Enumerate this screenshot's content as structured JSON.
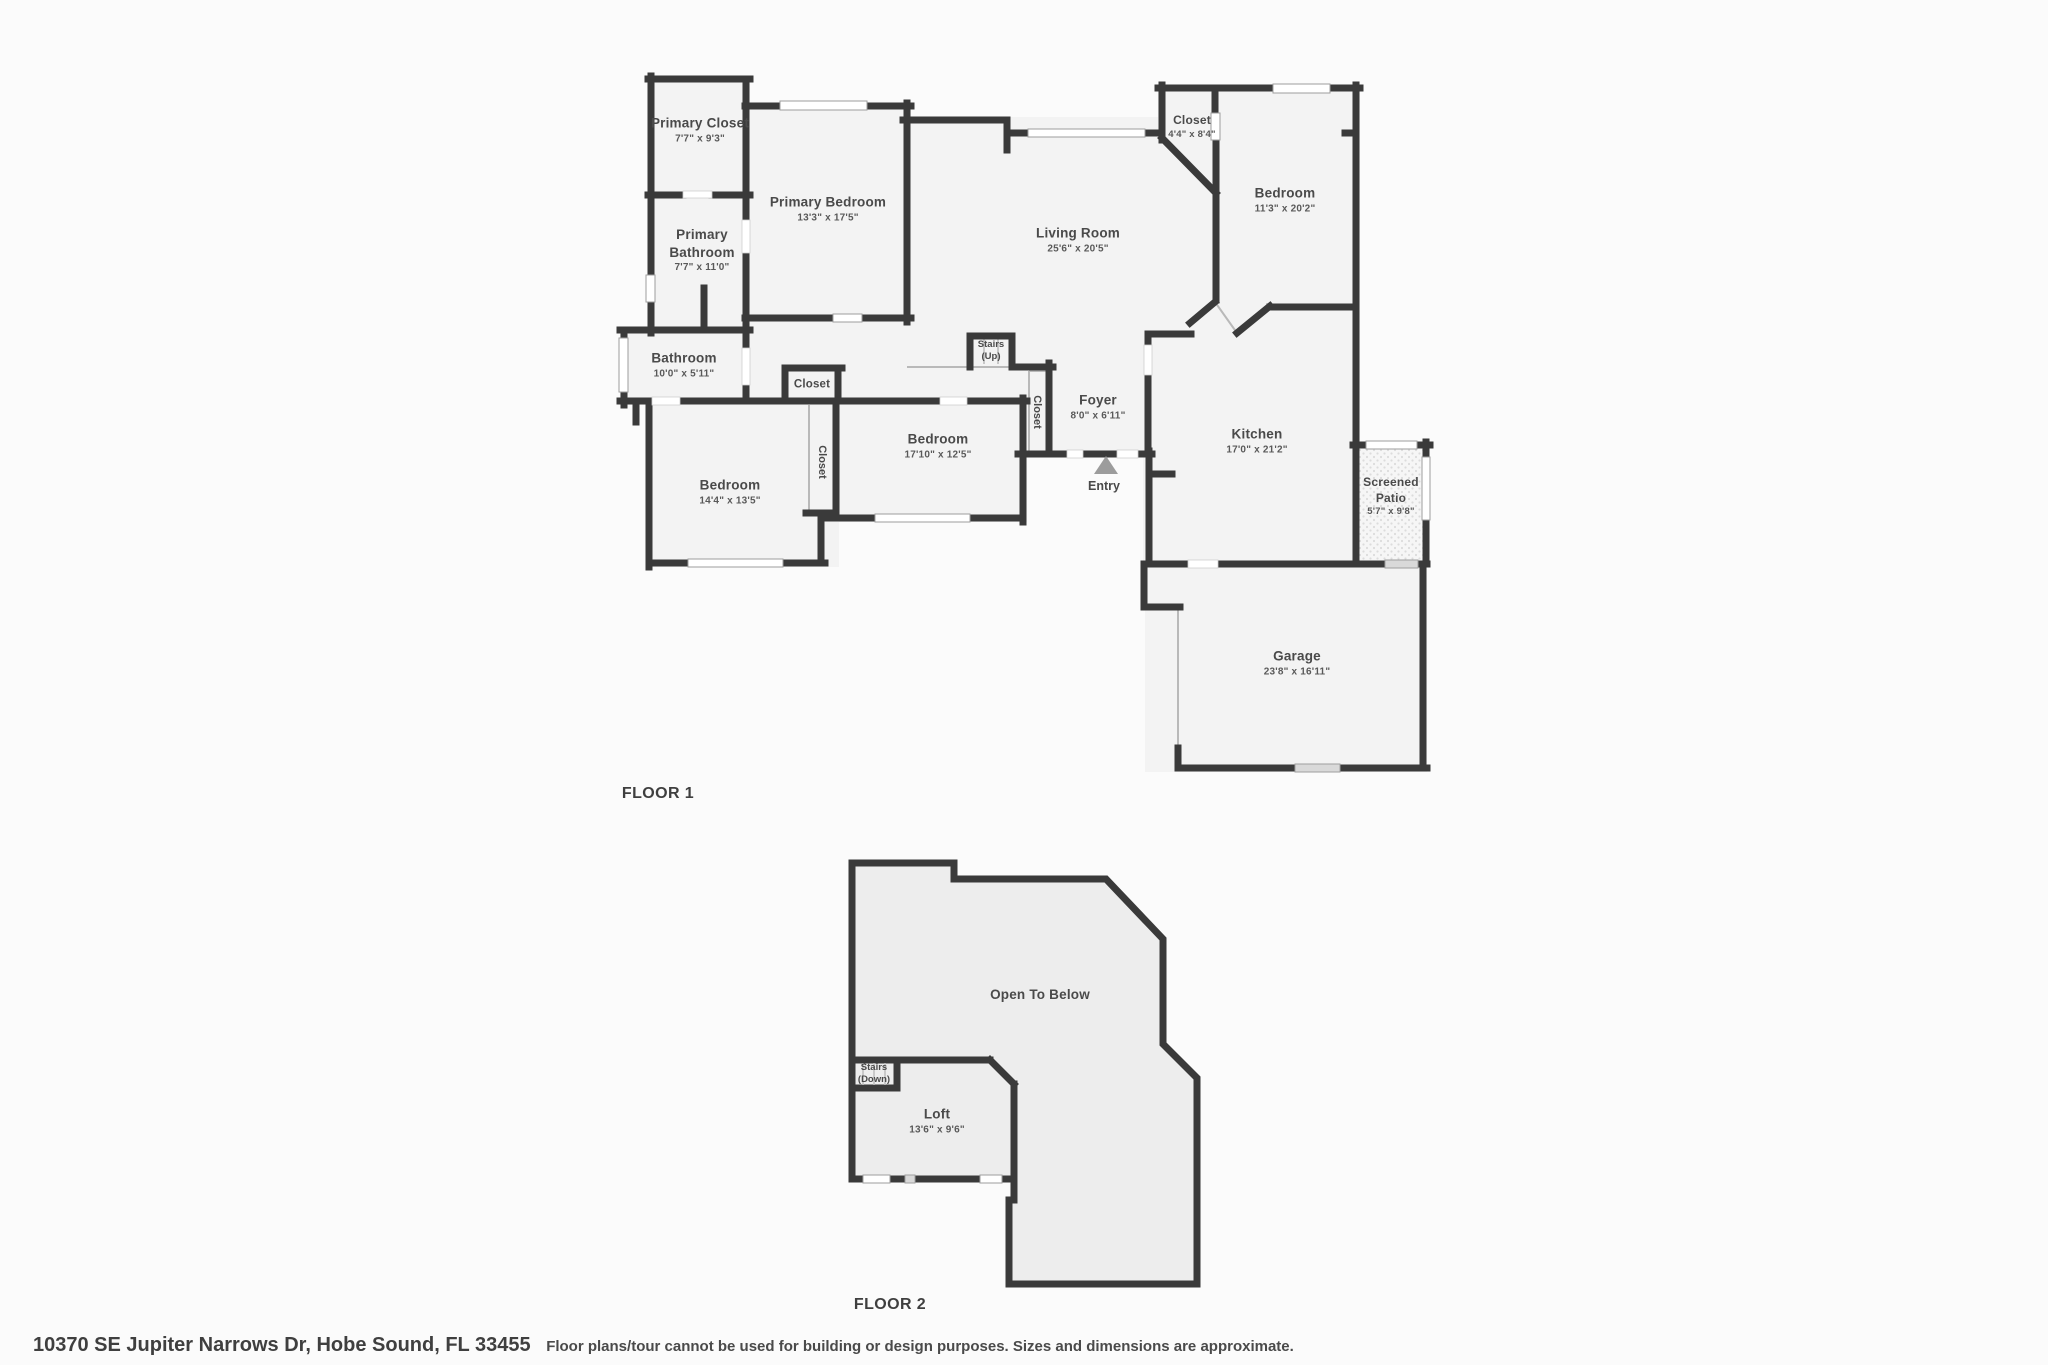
{
  "colors": {
    "wall": "#3a3a3a",
    "room_fill": "#f3f3f3",
    "floor2_fill": "#ededed",
    "background": "#fbfbfb",
    "label": "#4a4a4a",
    "entry_arrow": "#9c9c9c"
  },
  "floor1": {
    "title": "FLOOR 1",
    "rooms": {
      "primary_closet": {
        "name": "Primary Closet",
        "dims": "7'7\" x 9'3\""
      },
      "primary_bedroom": {
        "name": "Primary Bedroom",
        "dims": "13'3\" x 17'5\""
      },
      "primary_bathroom": {
        "name": "Primary Bathroom",
        "dims": "7'7\" x 11'0\""
      },
      "closet_top": {
        "name": "Closet",
        "dims": "4'4\" x 8'4\""
      },
      "bedroom_right": {
        "name": "Bedroom",
        "dims": "11'3\" x 20'2\""
      },
      "living_room": {
        "name": "Living Room",
        "dims": "25'6\" x 20'5\""
      },
      "stairs_up": {
        "line1": "Stairs",
        "line2": "(Up)"
      },
      "bathroom": {
        "name": "Bathroom",
        "dims": "10'0\" x 5'11\""
      },
      "closet_hall": {
        "name": "Closet"
      },
      "bedroom_middle": {
        "name": "Bedroom",
        "dims": "17'10\" x 12'5\""
      },
      "closet_left": {
        "name": "Closet"
      },
      "closet_foyer": {
        "name": "Closet"
      },
      "foyer": {
        "name": "Foyer",
        "dims": "8'0\" x 6'11\""
      },
      "entry": {
        "name": "Entry"
      },
      "kitchen": {
        "name": "Kitchen",
        "dims": "17'0\" x 21'2\""
      },
      "screened_patio": {
        "name": "Screened Patio",
        "dims": "5'7\" x 9'8\""
      },
      "bedroom_left": {
        "name": "Bedroom",
        "dims": "14'4\" x 13'5\""
      },
      "garage": {
        "name": "Garage",
        "dims": "23'8\" x 16'11\""
      }
    }
  },
  "floor2": {
    "title": "FLOOR 2",
    "rooms": {
      "open_to_below": {
        "name": "Open To Below"
      },
      "stairs_down": {
        "line1": "Stairs",
        "line2": "(Down)"
      },
      "loft": {
        "name": "Loft",
        "dims": "13'6\" x 9'6\""
      }
    }
  },
  "footer": {
    "address": "10370 SE Jupiter Narrows Dr, Hobe Sound, FL 33455",
    "disclaimer": "Floor plans/tour cannot be used for building or design purposes. Sizes and dimensions are approximate."
  }
}
